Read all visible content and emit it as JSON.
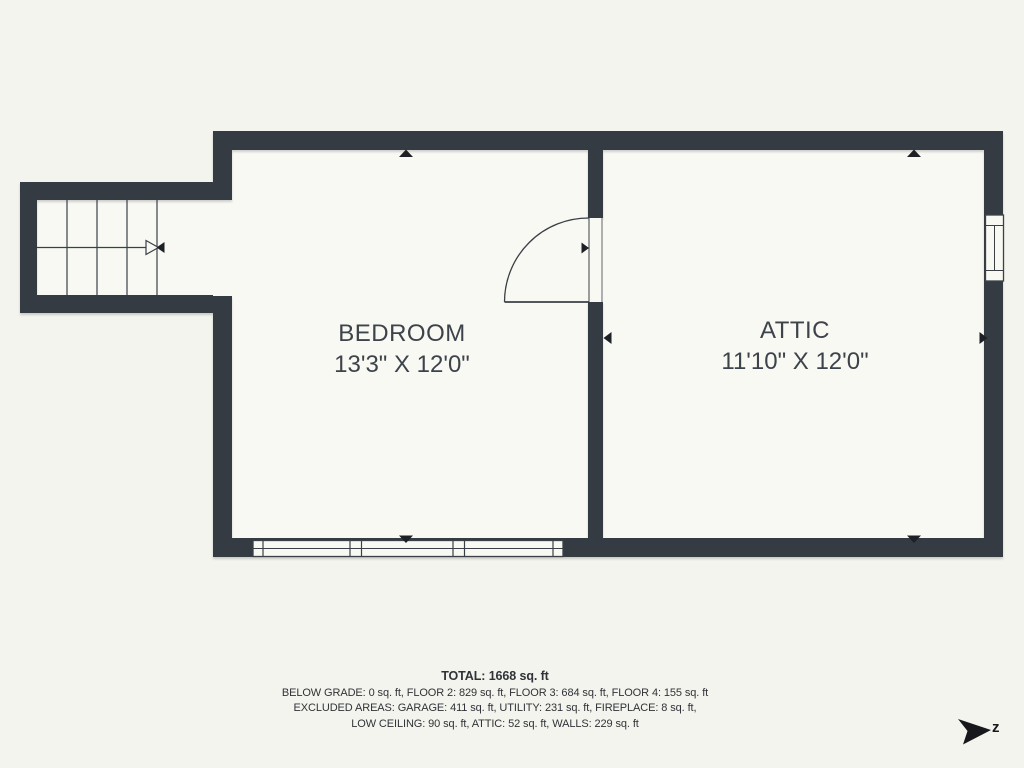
{
  "colors": {
    "background": "#f4f4ee",
    "room_fill": "#f9f9f4",
    "wall": "#353b42",
    "line": "#3a4046",
    "text": "#3d434a",
    "marker": "#1d2126",
    "logo": "#16181b"
  },
  "rooms": [
    {
      "name": "BEDROOM",
      "dimensions": "13'3\" X 12'0\""
    },
    {
      "name": "ATTIC",
      "dimensions": "11'10\" X 12'0\""
    }
  ],
  "footer": {
    "total": "TOTAL: 1668 sq. ft",
    "floors": "BELOW GRADE: 0 sq. ft, FLOOR 2: 829 sq. ft, FLOOR 3: 684 sq. ft, FLOOR 4: 155 sq. ft",
    "excluded_1": "EXCLUDED AREAS: GARAGE: 411 sq. ft, UTILITY: 231 sq. ft, FIREPLACE: 8 sq. ft,",
    "excluded_2": "LOW CEILING: 90 sq. ft, ATTIC: 52 sq. ft, WALLS: 229 sq. ft"
  },
  "logo": {
    "letter": "z"
  }
}
